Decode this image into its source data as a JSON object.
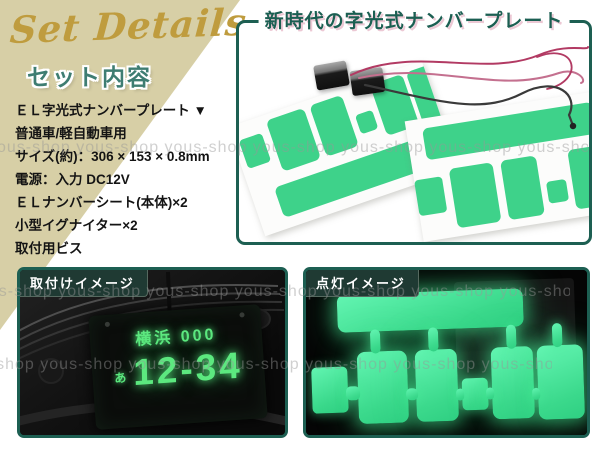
{
  "header": {
    "script_title": "Set Details"
  },
  "set_contents": {
    "heading": "セット内容",
    "items": [
      "ＥＬ字光式ナンバープレート ▼",
      "普通車/軽自動車用",
      "サイズ(約)：306 × 153 × 0.8mm",
      "電源：入力 DC12V",
      "ＥＬナンバーシート(本体)×2",
      "小型イグナイター×2",
      "取付用ビス"
    ]
  },
  "product_panel": {
    "title": "新時代の字光式ナンバープレート"
  },
  "install_panel": {
    "label": "取付けイメージ",
    "plate_top": "横浜 000",
    "plate_kana": "あ",
    "plate_digits": "12-34"
  },
  "glow_panel": {
    "label": "点灯イメージ"
  },
  "watermark": {
    "text": "yous-shop"
  },
  "colors": {
    "accent_teal": "#1d5f52",
    "heading_teal": "#3e7d72",
    "script_gold": "#bf9c3e",
    "tan_background": "#d7cfa6",
    "el_sheet_green": "#3ed28a",
    "glow_green": "#45e89b",
    "plate_text_green": "#5ce87f",
    "wire_pink": "#b5436a"
  }
}
